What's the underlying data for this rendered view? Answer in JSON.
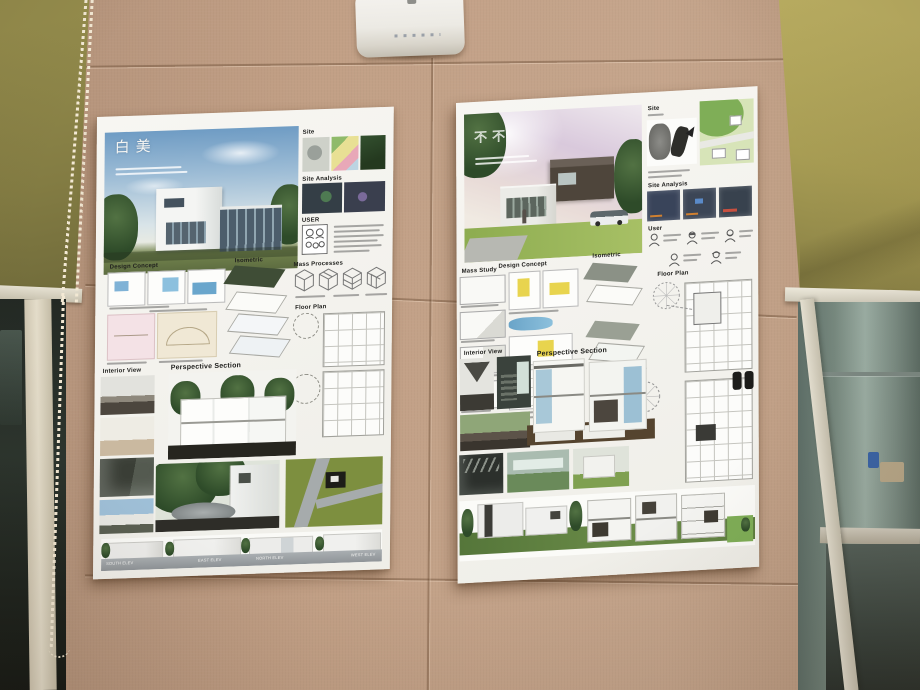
{
  "scene": {
    "colors": {
      "wall_panel_tan": "#c7a48a",
      "wall_upper_brown": "#8a7360",
      "side_wall_olive_left": "#8d8548",
      "side_wall_olive_right": "#b3a75c",
      "roller_blind_cream": "#e3ddcc",
      "window_glass_green": "#6e7f78",
      "poster_white": "#f3f2ed",
      "elevation_ground_gray": "#9aa0a4",
      "elevation_ground_green": "#5f7f3f"
    }
  },
  "posters": {
    "left": {
      "title": "白美",
      "labels": {
        "site": "Site",
        "site_analysis": "Site Analysis",
        "user": "USER",
        "mass_processes": "Mass Processes",
        "floor_plan": "Floor Plan",
        "design_concept": "Design Concept",
        "isometric": "Isometric",
        "interior_view": "Interior View",
        "perspective_section": "Perspective Section"
      },
      "elevations": [
        "SOUTH ELEV",
        "EAST ELEV",
        "NORTH ELEV",
        "WEST ELEV"
      ]
    },
    "right": {
      "title": "不不",
      "labels": {
        "site": "Site",
        "site_analysis": "Site Analysis",
        "user": "User",
        "mass_study": "Mass Study",
        "design_concept": "Design Concept",
        "isometric": "Isometric",
        "floor_plan": "Floor Plan",
        "interior_view": "Interior View",
        "perspective_section": "Perspective Section"
      }
    }
  }
}
